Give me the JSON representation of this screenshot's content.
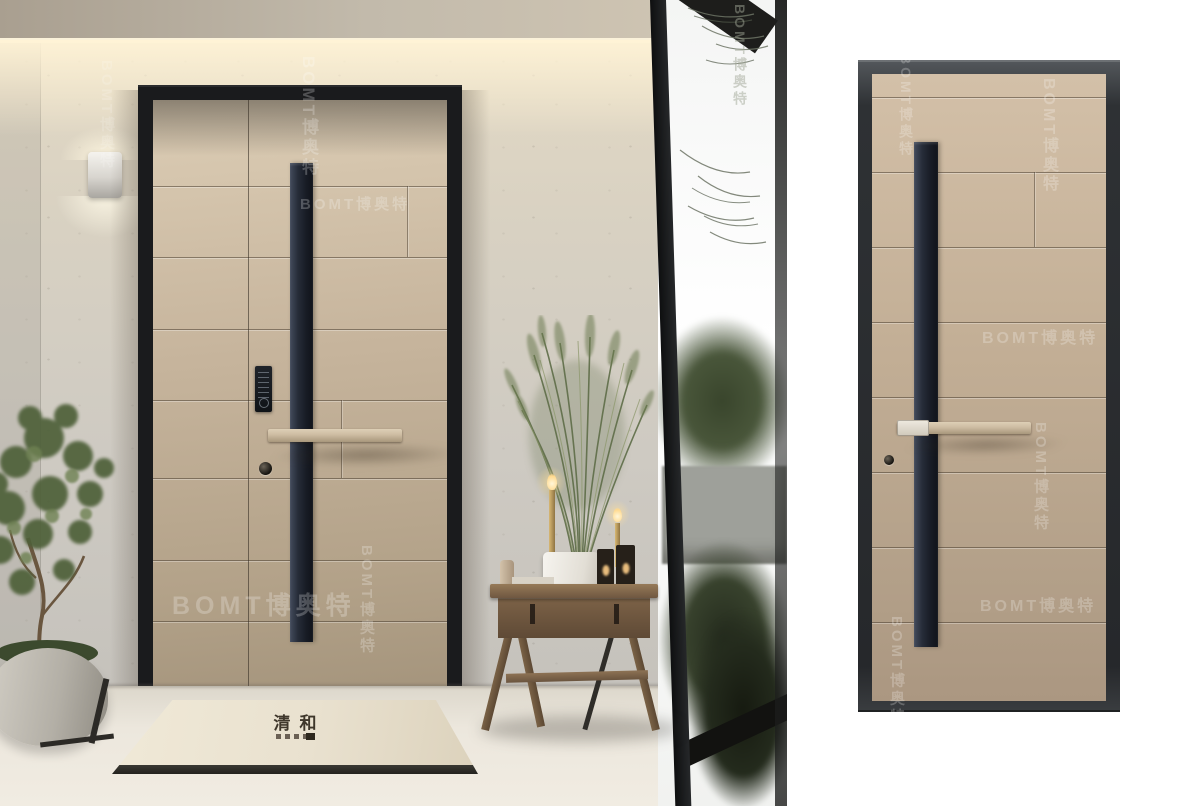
{
  "meta": {
    "description": "Product photograph of a modern champagne-colored security entry door: an installed mother-and-son door in a styled entryway on the left, and a standalone door render on a white background on the right."
  },
  "watermark": {
    "text": "BOMT博奥特",
    "color": "#ffffff"
  },
  "scene": {
    "doormat_text": "清和",
    "elements": [
      "wall lamp",
      "smart keypad lock",
      "long vertical handle stripe",
      "horizontal pull handle",
      "doormat",
      "potted tree",
      "wooden console table",
      "pampas grass plant",
      "candles",
      "lanterns",
      "floor-to-ceiling window with garden view"
    ]
  },
  "product": {
    "elements": [
      "dark steel door frame",
      "champagne door leaf with horizontal grooves",
      "vertical dark handle stripe",
      "horizontal pull handle with lock body",
      "keyhole"
    ]
  },
  "palette": {
    "background": "#ffffff",
    "door_panel": "#c6b49c",
    "door_frame": "#1a1b1d",
    "handle_bar": "#cdbca2",
    "handle_stripe": "#272c35",
    "wall": "#d2cec5",
    "ceiling": "#b9b0a2",
    "floor": "#ece7dd",
    "mat": "#e9e1cf",
    "foliage": "#49563a",
    "product_frame": "#2e3134"
  }
}
